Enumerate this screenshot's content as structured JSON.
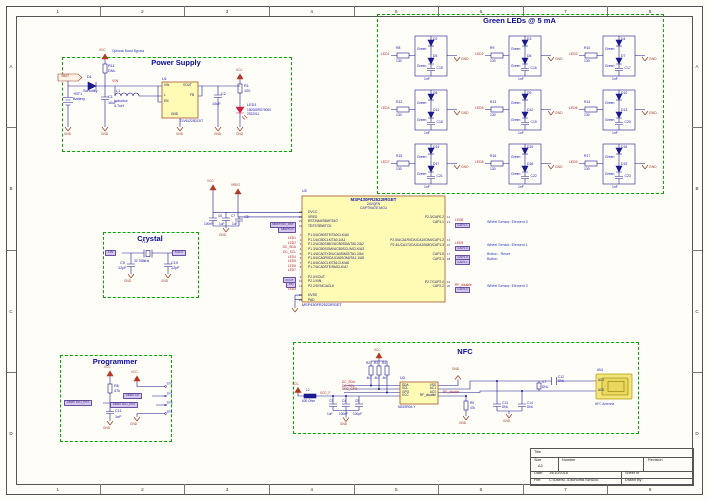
{
  "colors": {
    "accent_green": "#00a800",
    "title_blue": "#0a0aa0",
    "wire_blue": "#1b1b8e",
    "net_red": "#b3242c",
    "power_brown": "#9a3b26",
    "part_fill": "#fffbb4",
    "part_outline": "#a3532c",
    "port_fill": "#d4c6ec"
  },
  "sheet": {
    "cols": [
      "1",
      "2",
      "3",
      "4",
      "5",
      "6",
      "7",
      "8"
    ],
    "rows": [
      "A",
      "B",
      "C",
      "D"
    ]
  },
  "ps": {
    "title": "Power Supply",
    "note": "Optional Boost Bypass",
    "vbat": "VBAT",
    "vcc": "VCC",
    "vin": "VIN",
    "gnd": "GND",
    "bt1": "+BT1",
    "bt1_val": "Battery",
    "d1": "D1",
    "d1_val": "Schottky",
    "c1": "C1",
    "c1_val": "10uF",
    "r11": "R11",
    "r11_val": "DNL",
    "l1": "L1",
    "l1_val": "Inductor",
    "l1_val2": "4.7uH",
    "u1": "U1",
    "u1_part": "TLV61225DCKT",
    "u1_pins": {
      "vin": "VIN",
      "l": "L",
      "en": "EN",
      "vout": "VOUT",
      "fb": "FB",
      "gnd": "GND"
    },
    "c2": "C2",
    "c2_val": "10uF",
    "r1": "R1",
    "r1_val": "100",
    "led": "LED1",
    "led_val": "150060RS75000",
    "led_val2": "2322011"
  },
  "leds": {
    "title": "Green LEDs @ 5 mA",
    "gnd": "GND",
    "cells": [
      {
        "net": "LED1",
        "r": "R8",
        "rv": "130",
        "d1": "D2",
        "d2": "D5",
        "color": "Green",
        "c": "C15",
        "cv": "1nF"
      },
      {
        "net": "LED2",
        "r": "R9",
        "rv": "130",
        "d1": "D3",
        "d2": "D6",
        "color": "Green",
        "c": "C16",
        "cv": "1nF"
      },
      {
        "net": "LED3",
        "r": "R10",
        "rv": "130",
        "d1": "D4",
        "d2": "D7",
        "color": "Green",
        "c": "C17",
        "cv": "1nF"
      },
      {
        "net": "LED4",
        "r": "R12",
        "rv": "130",
        "d1": "D8",
        "d2": "D11",
        "color": "Green",
        "c": "C18",
        "cv": "1nF"
      },
      {
        "net": "LED5",
        "r": "R13",
        "rv": "130",
        "d1": "D9",
        "d2": "D12",
        "color": "Green",
        "c": "C19",
        "cv": "1nF"
      },
      {
        "net": "LED6",
        "r": "R14",
        "rv": "130",
        "d1": "D10",
        "d2": "D13",
        "color": "Green",
        "c": "C20",
        "cv": "1nF"
      },
      {
        "net": "LED7",
        "r": "R15",
        "rv": "130",
        "d1": "D14",
        "d2": "D17",
        "color": "Green",
        "c": "C21",
        "cv": "1nF"
      },
      {
        "net": "LED8",
        "r": "R16",
        "rv": "130",
        "d1": "D15",
        "d2": "D18",
        "color": "Green",
        "c": "C22",
        "cv": "1nF"
      },
      {
        "net": "LED9",
        "r": "R17",
        "rv": "130",
        "d1": "D16",
        "d2": "D19",
        "color": "Green",
        "c": "C23",
        "cv": "1nF"
      }
    ]
  },
  "xtal": {
    "title": "Crystal",
    "xin": "XIN",
    "xout": "XOUT",
    "y1": "Y1",
    "y1_val": "32.768kHz",
    "c9": "C9",
    "c9_val": "12pF",
    "c10": "C10",
    "c10_val": "12pF",
    "gnd": "GND"
  },
  "mcu": {
    "ref": "U2",
    "part": "MSP430FR2522IRGET",
    "pkg": "24VQFN",
    "desc": "CAPTIVATE MCU",
    "part2": "MSP430FR2522IRGET",
    "vcc": "VCC",
    "vreg": "VREG",
    "gnd": "GND",
    "c6": "C6",
    "c6_val": "100nF",
    "c7": "C7",
    "c7_val": "1uF",
    "c8": "C8",
    "c8_val": "1uF",
    "left": [
      {
        "net": "",
        "num": "21",
        "name": "DVCC"
      },
      {
        "net": "",
        "num": "20",
        "name": "VREG"
      },
      {
        "net": "SBWTDIO_RST",
        "style": "port",
        "num": "23",
        "name": "RST/NMI/SBWTDIO"
      },
      {
        "net": "SBWTCK",
        "style": "port",
        "num": "22",
        "name": "TEST/SBWTCK"
      },
      {
        "sp": true,
        "net": "",
        "num": "",
        "name": ""
      },
      {
        "net": "LED1",
        "style": "label",
        "num": "1",
        "name": "P1.0/UCB0STE/TA0CLK/A0"
      },
      {
        "net": "LED2",
        "style": "label",
        "num": "2",
        "name": "P1.1/UCB0CLK/TA0.1/A1"
      },
      {
        "net": "DC_SDA",
        "style": "label",
        "num": "3",
        "name": "P1.2/UCB0SIMO/UCB0SDA/TA0.2/A2"
      },
      {
        "net": "DC_SCL",
        "style": "label",
        "num": "4",
        "name": "P1.3/UCB0SOMI/UCB0SCL/MCLK/A3"
      },
      {
        "net": "LED4",
        "style": "label",
        "num": "5",
        "name": "P1.4/UCA0TXD/UCA0SIMO/TA1.2/A4"
      },
      {
        "net": "LED5",
        "style": "label",
        "num": "6",
        "name": "P1.5/UCA0RXD/UCA0SOMI/TA1.1/A5"
      },
      {
        "net": "LED6",
        "style": "label",
        "num": "7",
        "name": "P1.6/UCA0CLK/TA1CLK/A6"
      },
      {
        "net": "LED7",
        "style": "label",
        "num": "8",
        "name": "P1.7/UCA0STE/SMCLK/A7"
      },
      {
        "sp": true,
        "net": "",
        "num": "",
        "name": ""
      },
      {
        "net": "XOUT",
        "style": "port",
        "num": "9",
        "name": "P2.0/XOUT"
      },
      {
        "net": "XIN",
        "style": "port",
        "num": "10",
        "name": "P2.1/XIN"
      },
      {
        "net": "LED3",
        "style": "label",
        "num": "11",
        "name": "P2.2/SYNC/ACLK"
      },
      {
        "sp": true,
        "net": "",
        "num": "",
        "name": ""
      },
      {
        "net": "",
        "num": "19",
        "name": "DVSS"
      },
      {
        "net": "",
        "num": "25",
        "name": "PAD"
      }
    ],
    "right": [
      {
        "name": "P2.3/CAP0.2",
        "num": "12",
        "net": "LED8",
        "style": "label",
        "comment": ""
      },
      {
        "name": "CAP1.1",
        "num": "13",
        "net": "CAP1.1",
        "style": "port",
        "comment": "Wheel Sensor: Element 0"
      },
      {
        "sp": true,
        "name": "",
        "num": "",
        "net": "",
        "comment": ""
      },
      {
        "sp": true,
        "name": "",
        "num": "",
        "net": "",
        "comment": ""
      },
      {
        "sp": true,
        "name": "",
        "num": "",
        "net": "",
        "comment": ""
      },
      {
        "name": "P2.5/UCA1RXD/UCA1SOMI/CAP1.2",
        "num": "14",
        "net": "LED9",
        "style": "label",
        "comment": ""
      },
      {
        "name": "P2.4/UCA1TXD/UCA1SIMO/CAP1.3",
        "num": "15",
        "net": "CAP1.3",
        "style": "port",
        "comment": "Wheel Sensor: Element 1"
      },
      {
        "sp": true,
        "name": "",
        "num": "",
        "net": "",
        "comment": ""
      },
      {
        "name": "CAP1.0",
        "num": "17",
        "net": "CAP1.0",
        "style": "port",
        "comment": "Button - Reset"
      },
      {
        "name": "CAP2.1",
        "num": "18",
        "net": "CAP2.1",
        "style": "port",
        "comment": "Button"
      },
      {
        "sp": true,
        "name": "",
        "num": "",
        "net": "",
        "comment": ""
      },
      {
        "sp": true,
        "name": "",
        "num": "",
        "net": "",
        "comment": ""
      },
      {
        "sp": true,
        "name": "",
        "num": "",
        "net": "",
        "comment": ""
      },
      {
        "sp": true,
        "name": "",
        "num": "",
        "net": "",
        "comment": ""
      },
      {
        "name": "P2.7/CAP2.0",
        "num": "19",
        "net": "RF_disable",
        "style": "label",
        "comment": ""
      },
      {
        "name": "CAP2.2",
        "num": "20",
        "net": "CAP2.2",
        "style": "port",
        "comment": "Wheel Sensor: Element 2"
      }
    ]
  },
  "prog": {
    "title": "Programmer",
    "vcc": "VCC",
    "gnd": "GND",
    "rst_port": "SBWTDIO_RST",
    "r6": "R6",
    "r6_val": "47k",
    "c11": "C11",
    "c11_val": "1nF",
    "tck_port": "SBWTCK",
    "tp1": "TP1",
    "tp2": "TP2",
    "tp3": "TP3",
    "tp4": "TP4"
  },
  "nfc": {
    "title": "NFC",
    "vcc": "VCC",
    "gnd": "GND",
    "l2": "L2",
    "l2_val": "600 Ohm",
    "vccf": "VCC_F",
    "c3": "C3",
    "c3_val": "1uF",
    "c4": "C4",
    "c4_val": "100nF",
    "c5": "C5",
    "c5_val": "100pF",
    "r2": "R2",
    "r2_val": "4k7",
    "r3": "R3",
    "r3_val": "4k7",
    "r4": "R4",
    "r4_val": "4k7",
    "sda": "DC_SDA",
    "scl": "DC_SCL",
    "gpo": "NFC_GPO",
    "rf": "RF_disable",
    "u3": "U3",
    "u3_part": "M24SR04-Y",
    "u3_pins": {
      "sda": "SDA",
      "scl": "SCL",
      "gpo": "GPO",
      "vcc": "VCC",
      "vss": "VSS",
      "ac1": "AC1",
      "ac0": "AC0",
      "rf": "RF_disable"
    },
    "r5": "R5",
    "r5_val": "47k",
    "l3_val": "4.7",
    "l3_note": "DNL",
    "c12": "C12",
    "c12_val": "DNL",
    "c13": "C13",
    "c13_val": "DNL",
    "c14": "C14",
    "c14_val": "DNL",
    "an1": "AN1",
    "an1_name": "NFC Antenna",
    "ac1": "AC1",
    "ac0": "AC0"
  },
  "tb": {
    "title": "Title",
    "size": "Size",
    "size_val": "A3",
    "number": "Number",
    "revision": "Revision",
    "date": "Date:",
    "date_val": "19/10/2016",
    "sheet": "Sheet  of",
    "file": "File:",
    "file_val": "C:\\Users\\..\\Dschunta.SchDoc",
    "drawn": "Drawn By:"
  }
}
